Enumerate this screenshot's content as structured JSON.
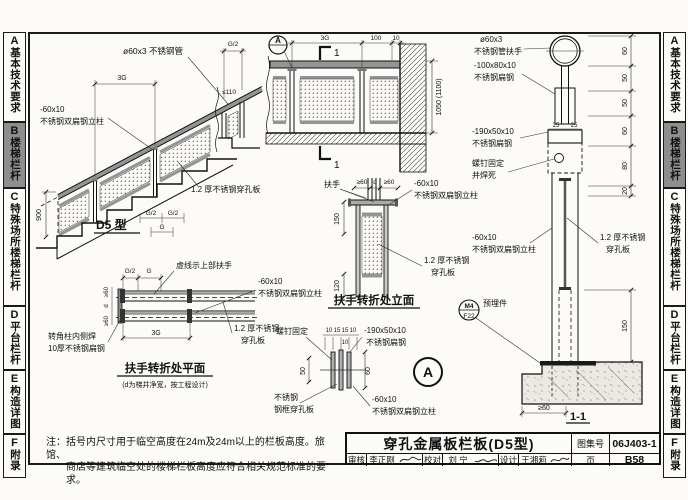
{
  "window": {
    "width": 688,
    "height": 500
  },
  "colors": {
    "paper": "#fcfbf8",
    "line": "#1a1a1a",
    "steel": "#949494",
    "tab_active_bg": "#8e8e8e"
  },
  "sidebar": {
    "active_index": 1,
    "tabs": [
      {
        "letter": "A",
        "label": "基本技术要求"
      },
      {
        "letter": "B",
        "label": "楼梯栏杆"
      },
      {
        "letter": "C",
        "label": "特殊场所楼梯栏杆"
      },
      {
        "letter": "D",
        "label": "平台栏杆"
      },
      {
        "letter": "E",
        "label": "构造详图"
      },
      {
        "letter": "F",
        "label": "附录"
      }
    ]
  },
  "note": {
    "line1": "注：括号内尺寸用于临空高度在24m及24m以上的栏板高度。旅馆、",
    "line2": "商店等建筑临空处的楼梯栏板高度应符合相关规范标准的要求。"
  },
  "titleblock": {
    "title": "穿孔金属板栏板(D5型)",
    "atlas_label": "图集号",
    "atlas_no": "06J403-1",
    "page_label": "页",
    "page_no": "B58",
    "reviewer_label": "审核",
    "reviewer_name": "李正刚",
    "proof_label": "校对",
    "proof_name": "刘 宁",
    "designer_label": "设计",
    "designer_name": "王湘莉"
  },
  "L": {
    "stair_tube": "ø60x3 不锈钢管",
    "stair_3g": "3G",
    "stair_g2_top": "G/2",
    "stair_gap": "≤110",
    "stair_post1": "-60x10",
    "stair_post2": "不锈钢双扁钢立柱",
    "stair_900": "900",
    "stair_panel": "1.2 厚不锈钢穿孔板",
    "stair_caption": "D5 型",
    "stair_g2b": "G/2",
    "stair_g2c": "G/2",
    "stair_g": "G",
    "land_3g": "3G",
    "land_100": "100",
    "land_10": "10",
    "land_1050": "1050 (1100)",
    "land_sec_top": "1",
    "land_sec_bot": "1",
    "land_bubble": "A",
    "turn_fs": "扶手",
    "turn_ge60a": "≥60",
    "turn_d": "d",
    "turn_ge60b": "≥60",
    "turn_post1": "-60x10",
    "turn_post2": "不锈钢双扁钢立柱",
    "turn_150": "150",
    "turn_120": "120",
    "turn_panel1": "1.2 厚不锈钢",
    "turn_panel2": "穿孔板",
    "turn_caption": "扶手转折处立面",
    "plan_g2": "G/2",
    "plan_g": "G",
    "plan_dash": "虚线示上部扶手",
    "plan_post1": "-60x10",
    "plan_post2": "不锈钢双扁钢立柱",
    "plan_panel1": "1.2 厚不锈钢",
    "plan_panel2": "穿孔板",
    "plan_corner1": "转角柱内侧焊",
    "plan_corner2": "10厚不锈钢扁钢",
    "plan_3g": "3G",
    "plan_ge60a": "≥60",
    "plan_d": "d",
    "plan_ge60b": "≥60",
    "plan_caption": "扶手转折处平面",
    "plan_subcaption": "(d为梯井净宽，按工程设计)",
    "da_screw": "螺钉固定",
    "da_10a": "10",
    "da_15a": "15",
    "da_15b": "15",
    "da_10b": "10",
    "da_10c": "10",
    "da_plate1": "-190x50x10",
    "da_plate2": "不锈钢扁钢",
    "da_50": "50",
    "da_60": "60",
    "da_frame1": "不锈钢",
    "da_frame2": "钢框穿孔板",
    "da_post1": "-60x10",
    "da_post2": "不锈钢双扁钢立柱",
    "da_bubble": "A",
    "s11_tube1": "ø60x3",
    "s11_tube2": "不锈钢管扶手",
    "s11_bar1": "-100x80x10",
    "s11_bar2": "不锈钢扁钢",
    "s11_25a": "25",
    "s11_25b": "25",
    "s11_plate1": "-190x50x10",
    "s11_plate2": "不锈钢扁钢",
    "s11_screw1": "螺钉固定",
    "s11_screw2": "并焊死",
    "s11_post1": "-60x10",
    "s11_post2": "不锈钢双扁钢立柱",
    "s11_panel1": "1.2 厚不锈钢",
    "s11_panel2": "穿孔板",
    "s11_embed": "预埋件",
    "s11_m4": "M4",
    "s11_f22": "F22",
    "s11_d60a": "60",
    "s11_d50a": "50",
    "s11_d50b": "50",
    "s11_d60b": "60",
    "s11_d80": "80",
    "s11_d20": "20",
    "s11_150": "150",
    "s11_ge60": "≥60",
    "s11_caption": "1-1"
  }
}
